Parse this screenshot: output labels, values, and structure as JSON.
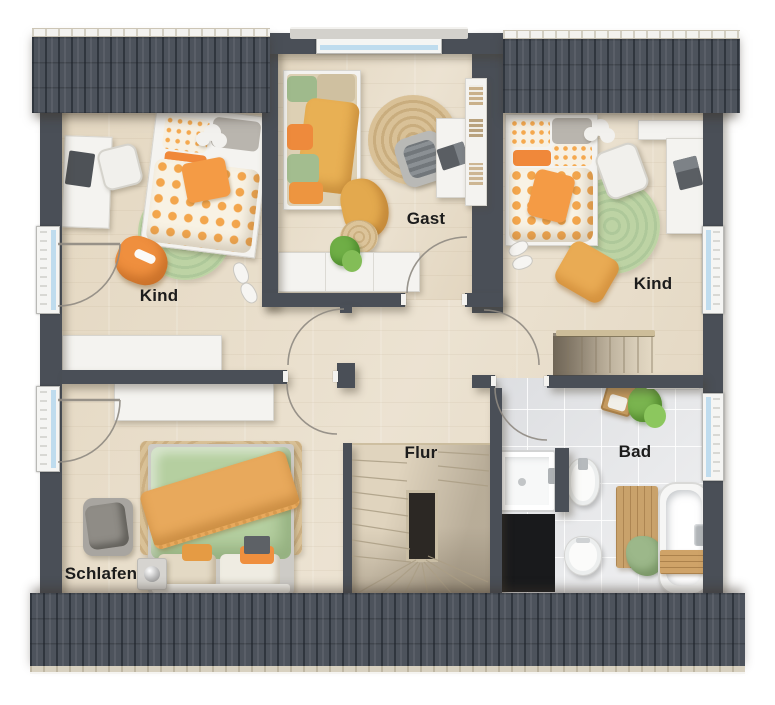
{
  "floorplan": {
    "type": "rendered top-down floor plan, upper storey",
    "rooms": [
      {
        "id": "kind-1",
        "label": "Kind"
      },
      {
        "id": "gast",
        "label": "Gast"
      },
      {
        "id": "kind-2",
        "label": "Kind"
      },
      {
        "id": "flur",
        "label": "Flur"
      },
      {
        "id": "schlafen",
        "label": "Schlafen"
      },
      {
        "id": "bad",
        "label": "Bad"
      }
    ],
    "palette": {
      "wall": "#4a4f57",
      "roof": "#4d535c",
      "wood_floor": "#e8ddc9",
      "tile_floor": "#e7e8ea",
      "accent_orange": "#ef8f3e",
      "accent_mustard": "#e8a95c",
      "accent_green": "#b5cfa0",
      "jute": "#d8bf97",
      "window_glass": "#bfdcee",
      "stair_void": "#1b1c1e"
    }
  }
}
